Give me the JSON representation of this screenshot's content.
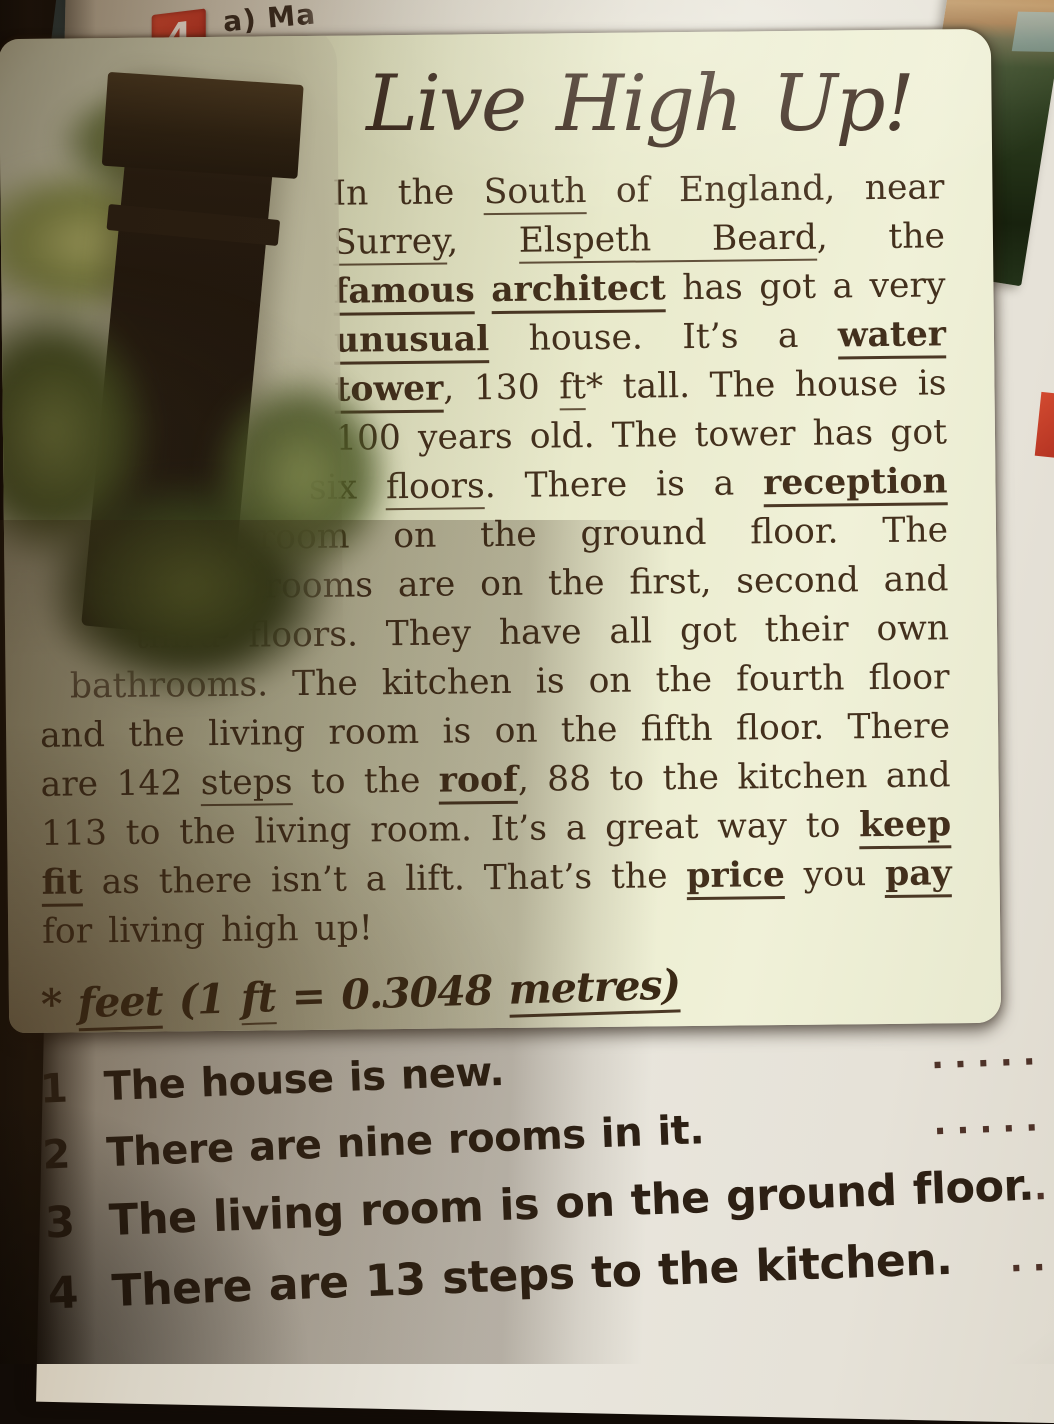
{
  "page": {
    "task_number": "4",
    "task_label_a": "a) Ma",
    "task_label_false": "(false)."
  },
  "card": {
    "title": "Live High Up!",
    "photo_alt": "water-tower-among-trees-photo",
    "article_segments": [
      {
        "t": "In the ",
        "u": 0
      },
      {
        "t": "South",
        "u": 1
      },
      {
        "t": " of England, near ",
        "u": 0
      },
      {
        "t": "Surrey",
        "u": 1
      },
      {
        "t": ", ",
        "u": 0
      },
      {
        "t": "Elspeth Beard",
        "u": 1
      },
      {
        "t": ", the ",
        "u": 0
      },
      {
        "t": "famous",
        "u": 2
      },
      {
        "t": " ",
        "u": 0
      },
      {
        "t": "architect",
        "u": 2
      },
      {
        "t": " has got a very ",
        "u": 0
      },
      {
        "t": "unusual",
        "u": 2
      },
      {
        "t": " house. It’s a ",
        "u": 0
      },
      {
        "t": "water tower",
        "u": 2
      },
      {
        "t": ", 130 ",
        "u": 0
      },
      {
        "t": "ft",
        "u": 1
      },
      {
        "t": "* tall. The house is 100 years old. The tower has got six ",
        "u": 0
      },
      {
        "t": "floors",
        "u": 1
      },
      {
        "t": ". There is a ",
        "u": 0
      },
      {
        "t": "reception",
        "u": 2
      },
      {
        "t": " room on the ground floor. The bedrooms are on the first, second and third floors. They have all got their own bathrooms. The kitchen is on the fourth floor and the living room is on the fifth floor. There are 142 ",
        "u": 0
      },
      {
        "t": "steps",
        "u": 1
      },
      {
        "t": " to the ",
        "u": 0
      },
      {
        "t": "roof",
        "u": 2
      },
      {
        "t": ", 88 to the kitchen and 113 to the living room. It’s a great way to ",
        "u": 0
      },
      {
        "t": "keep fit",
        "u": 2
      },
      {
        "t": " as there isn’t a lift. That’s the ",
        "u": 0
      },
      {
        "t": "price",
        "u": 2
      },
      {
        "t": " you ",
        "u": 0
      },
      {
        "t": "pay",
        "u": 2
      },
      {
        "t": " for living high up!",
        "u": 0
      }
    ],
    "footnote_segments": [
      {
        "t": "* ",
        "u": 0
      },
      {
        "t": "feet",
        "u": 2
      },
      {
        "t": " (1 ",
        "u": 0
      },
      {
        "t": "ft",
        "u": 1
      },
      {
        "t": " = 0.3048 ",
        "u": 0
      },
      {
        "t": "metres)",
        "u": 2
      }
    ]
  },
  "questions": {
    "items": [
      {
        "num": "1",
        "text": "The house is new.",
        "dots": "....."
      },
      {
        "num": "2",
        "text": "There are nine rooms in it.",
        "dots": "....."
      },
      {
        "num": "3",
        "text": "The living room is on the ground floor.",
        "dots": "....."
      },
      {
        "num": "4",
        "text": "There are 13 steps to the kitchen.",
        "dots": "...."
      }
    ]
  },
  "colors": {
    "badge_red": "#c23a27",
    "card_background": "#ecedd0",
    "text_brown": "#43301d",
    "teal_page_edge": "#5d888d"
  }
}
